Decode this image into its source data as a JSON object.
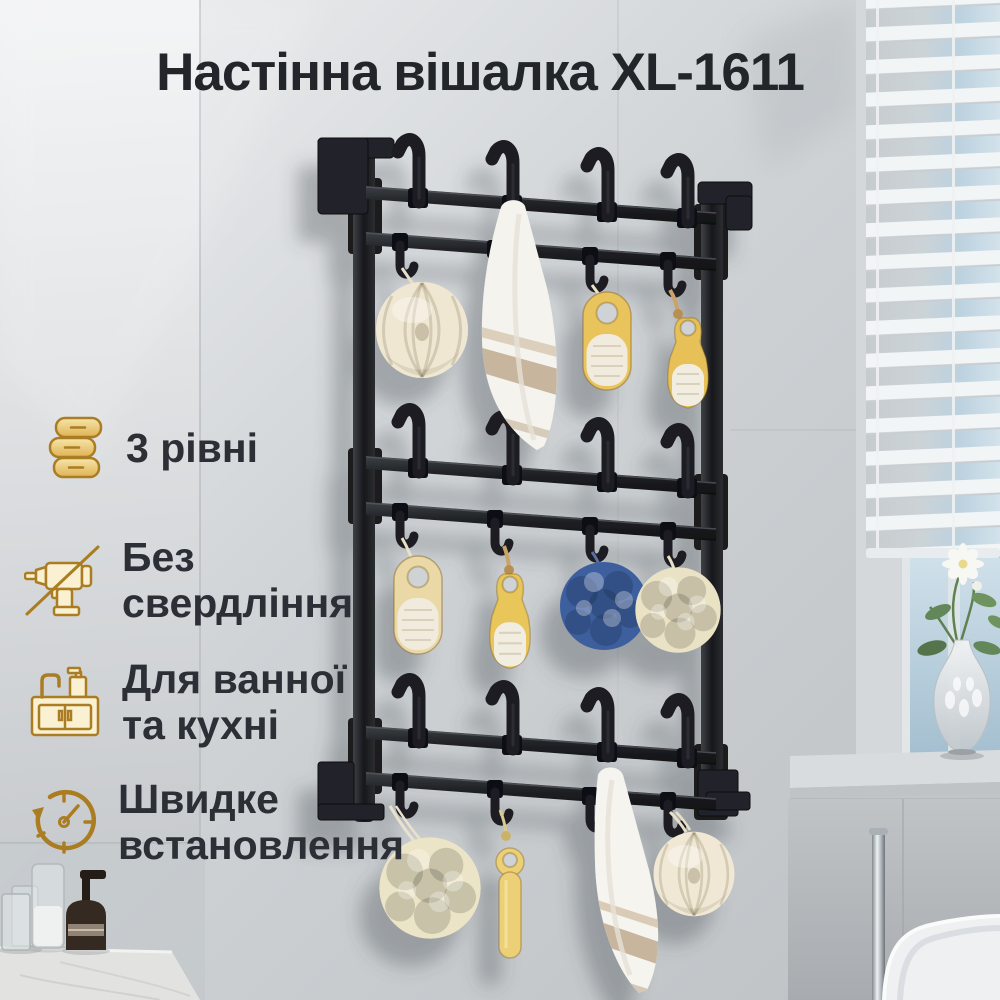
{
  "title": "Настінна вішалка XL-1611",
  "features": [
    {
      "icon": "towel-stack-icon",
      "lines": [
        "3 рівні"
      ]
    },
    {
      "icon": "no-drill-icon",
      "lines": [
        "Без",
        "свердління"
      ]
    },
    {
      "icon": "sink-icon",
      "lines": [
        "Для ванної",
        "та кухні"
      ]
    },
    {
      "icon": "quick-install-icon",
      "lines": [
        "Швидке",
        "встановлення"
      ]
    }
  ],
  "colors": {
    "title_text": "#22252a",
    "feature_text": "#2c3036",
    "gold": "#ab7d22",
    "gold_fill1": "#f6e6ab",
    "gold_fill2": "#dfb254",
    "gold_pale": "#faf0d2",
    "rack": "#1b1c20",
    "wall_mid": "#cfd3d6",
    "blue_loofah": "#3d5e9e",
    "cream": "#efe7d2",
    "wood": "#e7c159"
  }
}
